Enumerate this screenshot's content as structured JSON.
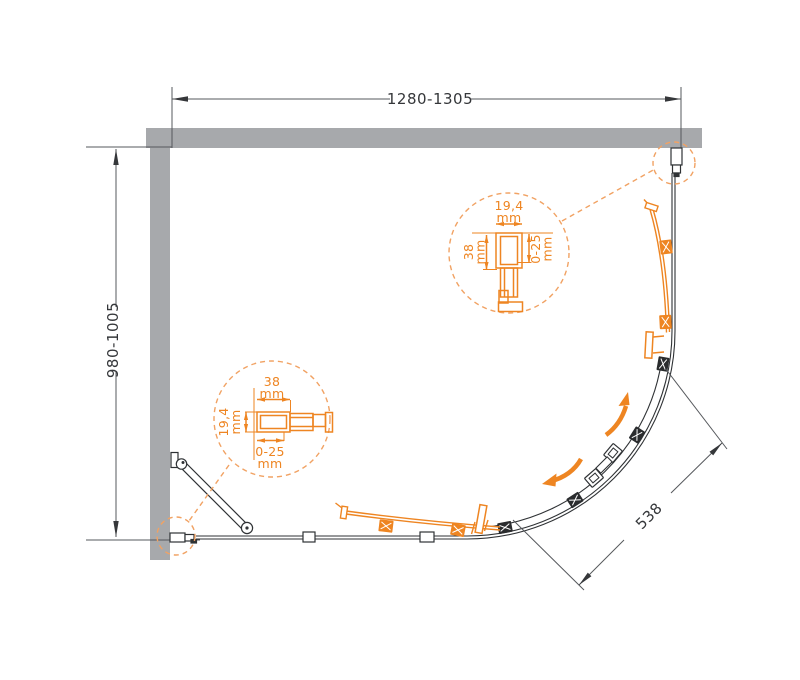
{
  "drawing": {
    "width_dim": "1280-1305",
    "depth_dim": "980-1005",
    "radius_dim": "538",
    "detail_top_right": {
      "w": "19,4",
      "w_unit": "mm",
      "d": "38",
      "d_unit": "mm",
      "adj": "0-25",
      "adj_unit": "mm"
    },
    "detail_bottom_left": {
      "w": "38",
      "w_unit": "mm",
      "d": "19,4",
      "d_unit": "mm",
      "adj": "0-25",
      "adj_unit": "mm"
    },
    "colors": {
      "orange": "#EE8522",
      "orange_dashed": "#F1A263",
      "wall_gray": "#A7A9AC",
      "line_dark": "#2F3235",
      "dim_text": "#35373A"
    }
  }
}
